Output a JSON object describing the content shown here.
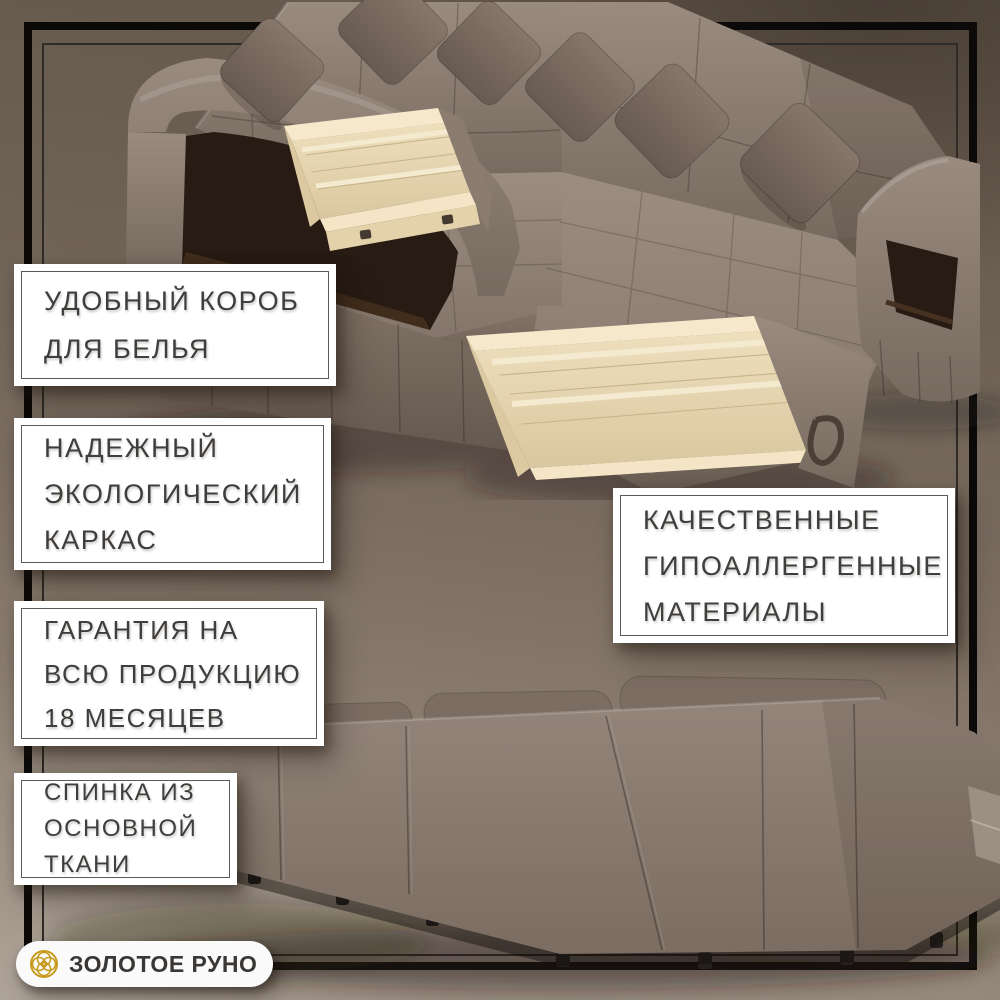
{
  "brand": {
    "name": "ЗОЛОТОЕ РУНО",
    "icon": "golden-fleece-rosette-icon",
    "accent_gold": "#c79a1e"
  },
  "features": [
    {
      "id": "laundry-box",
      "lines": [
        "УДОБНЫЙ КОРОБ",
        "ДЛЯ БЕЛЬЯ"
      ]
    },
    {
      "id": "eco-frame",
      "lines": [
        "НАДЕЖНЫЙ",
        "ЭКОЛОГИЧЕСКИЙ",
        "КАРКАС"
      ]
    },
    {
      "id": "warranty",
      "lines": [
        "ГАРАНТИЯ НА",
        "ВСЮ ПРОДУКЦИЮ",
        "18 МЕСЯЦЕВ"
      ]
    },
    {
      "id": "materials",
      "lines": [
        "КАЧЕСТВЕННЫЕ",
        "ГИПОАЛЛЕРГЕННЫЕ",
        "МАТЕРИАЛЫ"
      ]
    },
    {
      "id": "backrest",
      "lines": [
        "СПИНКА ИЗ",
        "ОСНОВНОЙ",
        "ТКАНИ"
      ]
    }
  ],
  "illustrations": {
    "top": "u-shaped-corner-sofa-with-open-storage-drawers",
    "bottom": "sofa-back-view"
  },
  "colors": {
    "frame": "#0b0a09",
    "box_bg": "#ffffff",
    "box_border": "#5a5a58",
    "text": "#403e3c",
    "fabric": "#8d7e73",
    "fabric_dark": "#6e6156",
    "drawer_wood": "#ead9b6",
    "niche_interior": "#271b13",
    "background_top": "#63564b",
    "background_bottom": "#9d9185"
  }
}
